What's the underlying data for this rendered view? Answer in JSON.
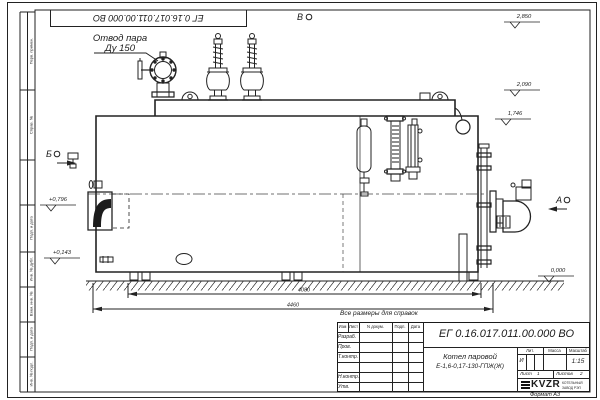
{
  "sheet": {
    "stamp_top_left": "ЕГ 0.16.017.011.00.000  ВО",
    "format_note": "Формат А3",
    "margin_labels": [
      "Перв. примен.",
      "Справ. №",
      "Подп. и дата",
      "Инв. № дубл.",
      "Взам. инв. №",
      "Подп. и дата",
      "Инв. № подл."
    ]
  },
  "drawing": {
    "callout": {
      "line1": "Отвод пара",
      "line2": "Ду 150"
    },
    "views": {
      "a": "А",
      "b": "Б",
      "v": "В"
    },
    "elevations": {
      "top": "2,850",
      "mid": "2,090",
      "low": "1,746",
      "zero": "0,000",
      "left_upper": "+0,796",
      "left_lower": "+0,143"
    },
    "dimensions": {
      "inner": "4080",
      "overall": "4460"
    }
  },
  "notes": {
    "reference": "Все размеры для справок"
  },
  "title_block": {
    "doc_number": "ЕГ 0.16.017.011.00.000  ВО",
    "product_name_line1": "Котел паровой",
    "product_name_line2": "Е-1,6-0,17-130-ГПЖ(Ж)",
    "header_cols": {
      "izm": "Изм",
      "list": "Лист",
      "doc": "N докум.",
      "sign": "Подп.",
      "date": "Дата"
    },
    "rows": {
      "razrab": "Разраб.",
      "prov": "Пров.",
      "tkontr": "Т.контр.",
      "nkontr": "Н.контр.",
      "utv": "Утв."
    },
    "lit_label": "Лит.",
    "mass_label": "Масса",
    "scale_label": "Масштаб",
    "lit_value": "И",
    "scale_value": "1:15",
    "sheet_label": "Лист",
    "sheet_value": "1",
    "sheets_label": "Листов",
    "sheets_value": "2",
    "logo_text": "KVZR",
    "logo_sub1": "КОТЕЛЬНЫЙ",
    "logo_sub2": "ЗАВОД РЭП"
  }
}
